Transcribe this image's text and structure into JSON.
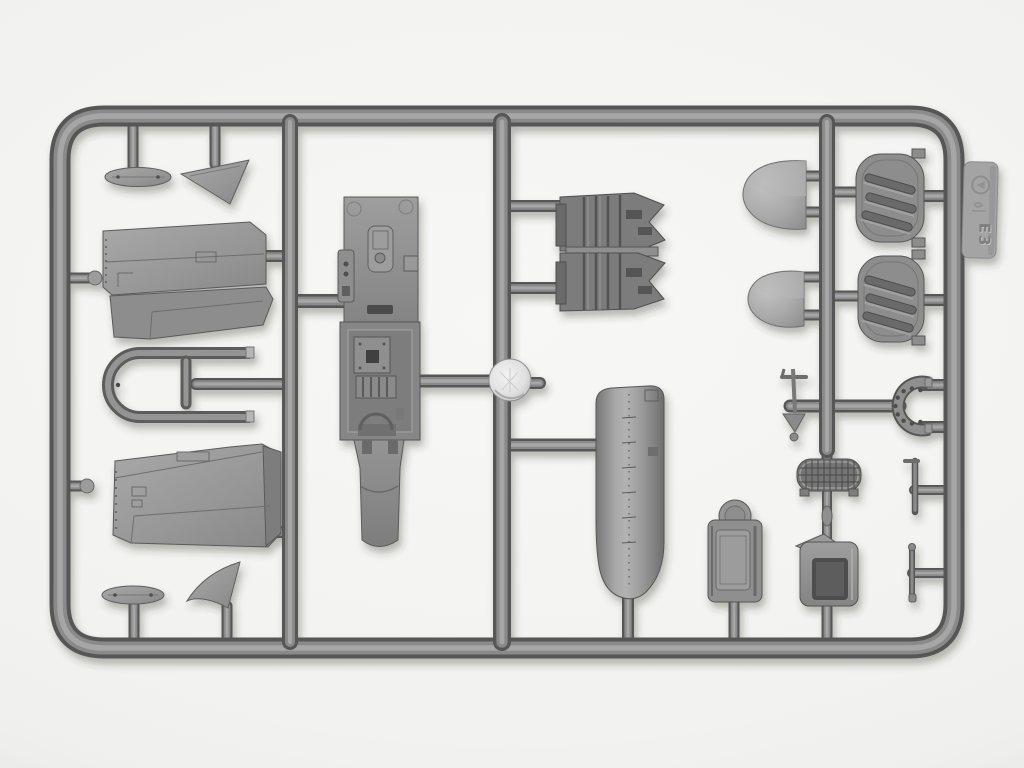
{
  "scene": {
    "type": "product-photo",
    "subject": "Injection-molded grey styrene model kit sprue with aircraft parts, photographed on a white background",
    "background_color": "#f2f2f0",
    "plastic": {
      "base": "#8c8c8c",
      "shadow": "#575757",
      "highlight": "#a6a6a6",
      "dark_detail": "#4e4e4e",
      "gate_disc": "#e2e2e2"
    }
  },
  "sprue": {
    "material": "grey styrene plastic",
    "frame_shape": "rounded rectangle with three internal vertical runners",
    "tag": {
      "marking": "E3",
      "symbols": [
        "recycling-mark"
      ],
      "position": "molded tab outside the top-right frame edge"
    },
    "parts": [
      {
        "name": "small-fairing-top",
        "description": "small elongated fairing with two locating holes",
        "location": "top-left"
      },
      {
        "name": "fin-triangle-top",
        "description": "triangular fin / cowl panel",
        "location": "top-left"
      },
      {
        "name": "wing-half-upper",
        "description": "tapered wing half with panel lines and hatch detail",
        "location": "left upper"
      },
      {
        "name": "wingtip-bow",
        "description": "U-shaped wingtip bow with two prongs",
        "location": "left middle"
      },
      {
        "name": "t-mast",
        "description": "small T-shaped mast piece",
        "location": "left middle"
      },
      {
        "name": "wing-half-lower",
        "description": "second tapered wing half with rivet detail and end rib",
        "location": "left lower"
      },
      {
        "name": "small-fairing-bottom",
        "description": "small elongated fairing with locating holes",
        "location": "bottom-left"
      },
      {
        "name": "fin-triangle-bottom",
        "description": "triangular fin",
        "location": "bottom-left"
      },
      {
        "name": "cockpit-floor-panel",
        "description": "long interior panel with raised cockpit details, side tab and lower skid",
        "location": "center"
      },
      {
        "name": "sprue-gate-disc",
        "description": "bright circular injection-gate disc on the central runner",
        "location": "center"
      },
      {
        "name": "engine-half-upper",
        "description": "engine block half with ribbed cylinder banks",
        "location": "upper center-right"
      },
      {
        "name": "engine-half-lower",
        "description": "engine block half with ribbed cylinder banks",
        "location": "upper center-right"
      },
      {
        "name": "cowling-cylinder",
        "description": "large rounded cowling panel with riveted center seam",
        "location": "center-right"
      },
      {
        "name": "cowling-dome-large",
        "description": "domed spoon-shaped cowling piece",
        "location": "top-right"
      },
      {
        "name": "cowling-dome-small",
        "description": "smaller domed cowling piece",
        "location": "right"
      },
      {
        "name": "louver-shutter-upper",
        "description": "shield-shaped panel with three diagonal louver slots",
        "location": "top-right"
      },
      {
        "name": "louver-shutter-lower",
        "description": "shield-shaped panel with three diagonal louver slots",
        "location": "right"
      },
      {
        "name": "pitot-mast",
        "description": "thin mast with crossbar and arrow-shaped foot",
        "location": "right of center"
      },
      {
        "name": "perforated-collar",
        "description": "horseshoe-shaped strip with a row of small holes",
        "location": "right"
      },
      {
        "name": "radiator-grille",
        "description": "oval mesh radiator matrix with mounting feet",
        "location": "right"
      },
      {
        "name": "seat-backrest",
        "description": "seat backrest with round headrest",
        "location": "bottom-right"
      },
      {
        "name": "bucket-seat",
        "description": "open bucket seat with rolled top flap",
        "location": "bottom-right"
      },
      {
        "name": "lever-handle-upper",
        "description": "thin lever / handle pin",
        "location": "far right"
      },
      {
        "name": "lever-handle-lower",
        "description": "thin lever / handle pin",
        "location": "far right"
      }
    ]
  }
}
